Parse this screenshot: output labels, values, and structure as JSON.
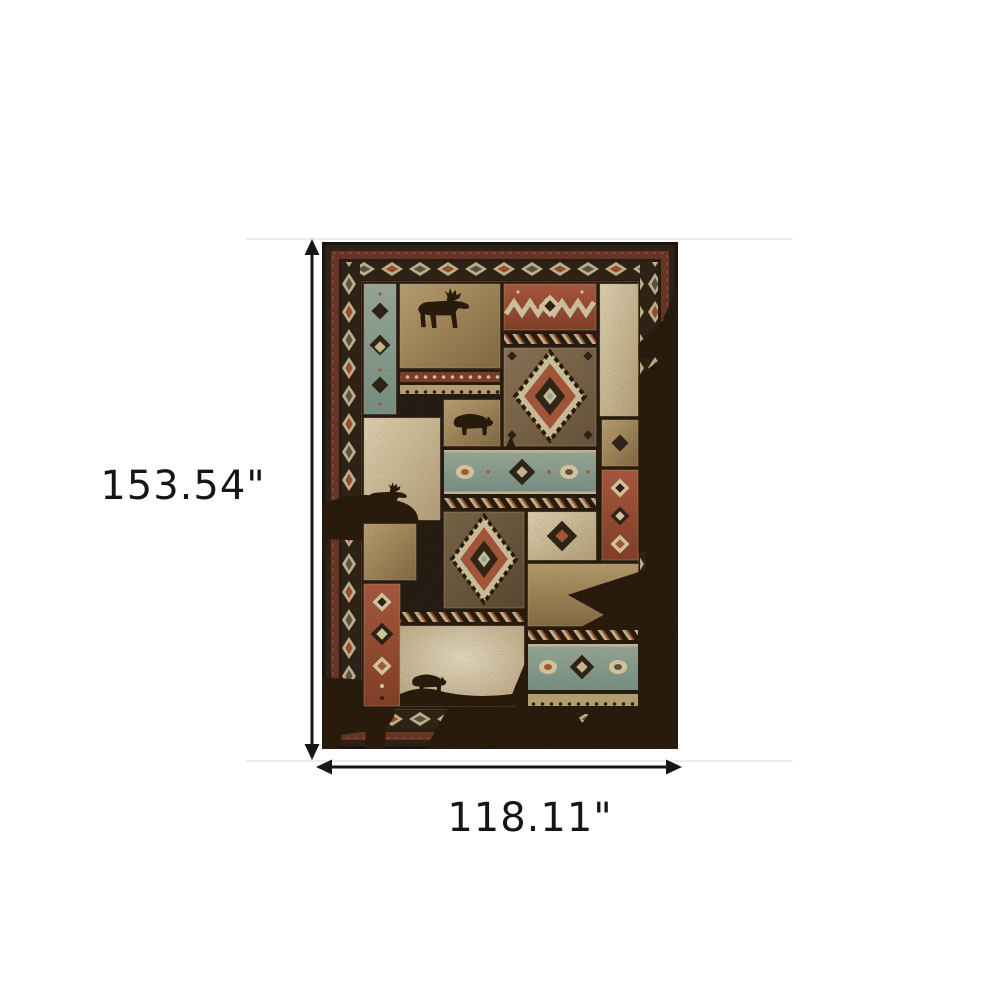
{
  "annotation": {
    "height_label": "153.54\"",
    "width_label": "118.11\"",
    "arrow_color": "#161616",
    "text_color": "#161616"
  },
  "product": {
    "name": "Rustic lodge patchwork area rug",
    "motifs": [
      "moose",
      "bear",
      "pine tree",
      "pine bough",
      "southwestern diamond medallion",
      "diamond chain border"
    ],
    "palette": {
      "background": "#ffffff",
      "rug_outer_edge": "#171008",
      "rug_border_brown": "#2b1f13",
      "rug_border_red": "#6d3424",
      "chain_cream": "#d2c096",
      "panel_teal": "#8ba79a",
      "panel_red": "#a4513a",
      "panel_tan": "#b79c6c",
      "panel_cream": "#e9dcba",
      "panel_brown": "#6f5d43",
      "silhouette": "#241708",
      "accent_rust": "#b05c3a",
      "accent_teal": "#9fb6ac"
    }
  }
}
